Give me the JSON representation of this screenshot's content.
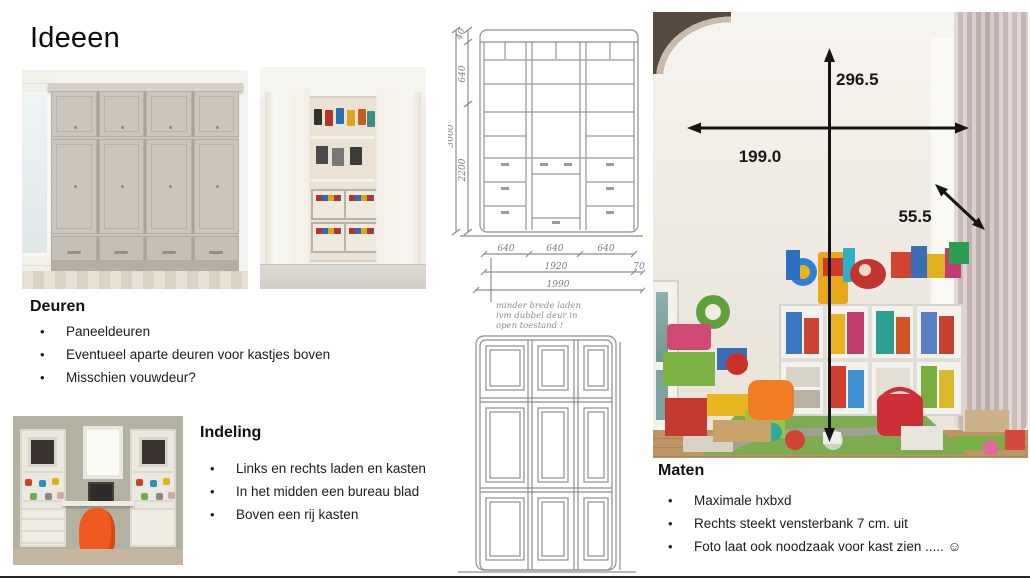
{
  "page": {
    "title": "Ideeen"
  },
  "sections": {
    "deuren": {
      "heading": "Deuren",
      "bullets": [
        "Paneeldeuren",
        "Eventueel aparte deuren voor kastjes boven",
        "Misschien vouwdeur?"
      ]
    },
    "indeling": {
      "heading": "Indeling",
      "bullets": [
        "Links en rechts laden en kasten",
        "In het midden een bureau blad",
        "Boven een rij kasten"
      ]
    },
    "maten": {
      "heading": "Maten",
      "bullets": [
        "Maximale hxbxd",
        "Rechts steekt vensterbank 7 cm. uit",
        "Foto laat ook noodzaak voor kast zien ..... ☺"
      ]
    }
  },
  "room_measurements": {
    "height_cm": "296.5",
    "width_cm": "199.0",
    "depth_cm": "55.5"
  },
  "sketch_dimensions": {
    "total_height": "3000",
    "top_trim": "40",
    "upper_section": "640",
    "lower_section": "2200",
    "bay1": "640",
    "bay2": "640",
    "bay3": "640",
    "inner_width": "1920",
    "side_offset": "70",
    "total_width": "1990",
    "note_line1": "minder brede laden",
    "note_line2": "ivm dubbel deur in",
    "note_line3": "open toestand !"
  },
  "colors": {
    "arrow_black": "#151515",
    "pencil_gray": "#8e8e8e",
    "accent_orange_chair": "#f05a1f"
  }
}
